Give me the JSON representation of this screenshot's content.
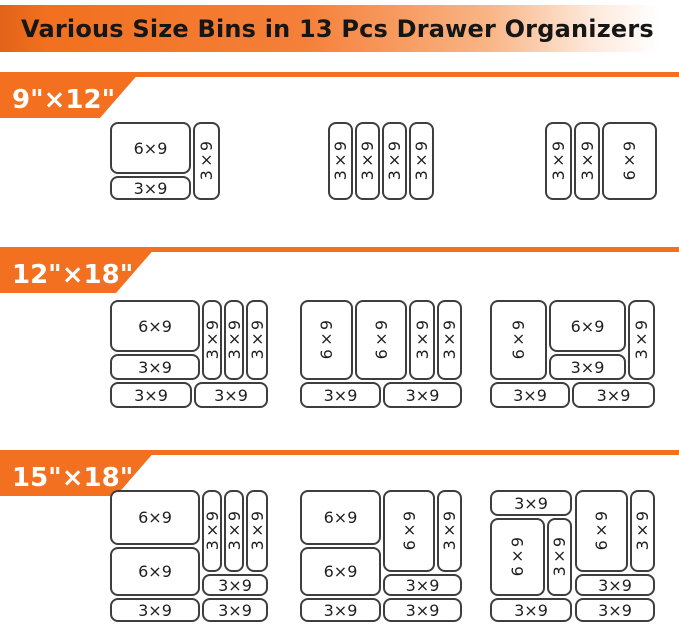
{
  "title": "Various Size Bins in 13 Pcs Drawer Organizers",
  "colors": {
    "accent": "#F2701F",
    "bin_border": "#3E3E3E",
    "title_text": "#161616",
    "section_label_text": "#FFFFFF"
  },
  "sections": [
    {
      "label": "9\"×12\"",
      "divider_y": 72,
      "label_width": 140,
      "arrangements": [
        {
          "x": 110,
          "y": 122,
          "w": 110,
          "h": 78,
          "bins": [
            {
              "label": "6×9",
              "orient": "h",
              "x": 0,
              "y": 0,
              "w": 81,
              "h": 52
            },
            {
              "label": "3×9",
              "orient": "h",
              "x": 0,
              "y": 54,
              "w": 81,
              "h": 24
            },
            {
              "label": "3×9",
              "orient": "v",
              "x": 83,
              "y": 0,
              "w": 27,
              "h": 78
            }
          ]
        },
        {
          "x": 328,
          "y": 122,
          "w": 106,
          "h": 78,
          "bins": [
            {
              "label": "3×9",
              "orient": "v",
              "x": 0,
              "y": 0,
              "w": 25,
              "h": 78
            },
            {
              "label": "3×9",
              "orient": "v",
              "x": 27,
              "y": 0,
              "w": 25,
              "h": 78
            },
            {
              "label": "3×9",
              "orient": "v",
              "x": 54,
              "y": 0,
              "w": 25,
              "h": 78
            },
            {
              "label": "3×9",
              "orient": "v",
              "x": 81,
              "y": 0,
              "w": 25,
              "h": 78
            }
          ]
        },
        {
          "x": 545,
          "y": 122,
          "w": 112,
          "h": 78,
          "bins": [
            {
              "label": "3×9",
              "orient": "v",
              "x": 0,
              "y": 0,
              "w": 27,
              "h": 78
            },
            {
              "label": "3×9",
              "orient": "v",
              "x": 29,
              "y": 0,
              "w": 26,
              "h": 78
            },
            {
              "label": "6×9",
              "orient": "v",
              "x": 57,
              "y": 0,
              "w": 55,
              "h": 78
            }
          ]
        }
      ]
    },
    {
      "label": "12\"×18\"",
      "divider_y": 247,
      "label_width": 156,
      "arrangements": [
        {
          "x": 110,
          "y": 300,
          "w": 158,
          "h": 108,
          "bins": [
            {
              "label": "6×9",
              "orient": "h",
              "x": 0,
              "y": 0,
              "w": 90,
              "h": 52
            },
            {
              "label": "3×9",
              "orient": "h",
              "x": 0,
              "y": 54,
              "w": 90,
              "h": 26
            },
            {
              "label": "3×9",
              "orient": "v",
              "x": 92,
              "y": 0,
              "w": 20,
              "h": 80
            },
            {
              "label": "3×9",
              "orient": "v",
              "x": 114,
              "y": 0,
              "w": 20,
              "h": 80
            },
            {
              "label": "3×9",
              "orient": "v",
              "x": 136,
              "y": 0,
              "w": 22,
              "h": 80
            },
            {
              "label": "3×9",
              "orient": "h",
              "x": 0,
              "y": 82,
              "w": 82,
              "h": 26
            },
            {
              "label": "3×9",
              "orient": "h",
              "x": 84,
              "y": 82,
              "w": 74,
              "h": 26
            }
          ]
        },
        {
          "x": 300,
          "y": 300,
          "w": 162,
          "h": 108,
          "bins": [
            {
              "label": "6×9",
              "orient": "v",
              "x": 0,
              "y": 0,
              "w": 53,
              "h": 80
            },
            {
              "label": "6×9",
              "orient": "v",
              "x": 55,
              "y": 0,
              "w": 52,
              "h": 80
            },
            {
              "label": "3×9",
              "orient": "v",
              "x": 109,
              "y": 0,
              "w": 26,
              "h": 80
            },
            {
              "label": "3×9",
              "orient": "v",
              "x": 137,
              "y": 0,
              "w": 25,
              "h": 80
            },
            {
              "label": "3×9",
              "orient": "h",
              "x": 0,
              "y": 82,
              "w": 81,
              "h": 26
            },
            {
              "label": "3×9",
              "orient": "h",
              "x": 83,
              "y": 82,
              "w": 79,
              "h": 26
            }
          ]
        },
        {
          "x": 490,
          "y": 300,
          "w": 165,
          "h": 108,
          "bins": [
            {
              "label": "6×9",
              "orient": "v",
              "x": 0,
              "y": 0,
              "w": 57,
              "h": 80
            },
            {
              "label": "6×9",
              "orient": "h",
              "x": 59,
              "y": 0,
              "w": 77,
              "h": 52
            },
            {
              "label": "3×9",
              "orient": "h",
              "x": 59,
              "y": 54,
              "w": 77,
              "h": 26
            },
            {
              "label": "3×9",
              "orient": "v",
              "x": 138,
              "y": 0,
              "w": 27,
              "h": 80
            },
            {
              "label": "3×9",
              "orient": "h",
              "x": 0,
              "y": 82,
              "w": 80,
              "h": 26
            },
            {
              "label": "3×9",
              "orient": "h",
              "x": 82,
              "y": 82,
              "w": 83,
              "h": 26
            }
          ]
        }
      ]
    },
    {
      "label": "15\"×18\"",
      "divider_y": 450,
      "label_width": 156,
      "arrangements": [
        {
          "x": 110,
          "y": 490,
          "w": 158,
          "h": 132,
          "bins": [
            {
              "label": "6×9",
              "orient": "h",
              "x": 0,
              "y": 0,
              "w": 90,
              "h": 55
            },
            {
              "label": "6×9",
              "orient": "h",
              "x": 0,
              "y": 57,
              "w": 90,
              "h": 49
            },
            {
              "label": "3×9",
              "orient": "v",
              "x": 92,
              "y": 0,
              "w": 20,
              "h": 82
            },
            {
              "label": "3×9",
              "orient": "v",
              "x": 114,
              "y": 0,
              "w": 20,
              "h": 82
            },
            {
              "label": "3×9",
              "orient": "v",
              "x": 136,
              "y": 0,
              "w": 22,
              "h": 82
            },
            {
              "label": "3×9",
              "orient": "h",
              "x": 92,
              "y": 84,
              "w": 66,
              "h": 22
            },
            {
              "label": "3×9",
              "orient": "h",
              "x": 0,
              "y": 108,
              "w": 90,
              "h": 24
            },
            {
              "label": "3×9",
              "orient": "h",
              "x": 92,
              "y": 108,
              "w": 66,
              "h": 24
            }
          ]
        },
        {
          "x": 300,
          "y": 490,
          "w": 162,
          "h": 132,
          "bins": [
            {
              "label": "6×9",
              "orient": "h",
              "x": 0,
              "y": 0,
              "w": 81,
              "h": 55
            },
            {
              "label": "6×9",
              "orient": "h",
              "x": 0,
              "y": 57,
              "w": 81,
              "h": 49
            },
            {
              "label": "6×9",
              "orient": "v",
              "x": 83,
              "y": 0,
              "w": 52,
              "h": 82
            },
            {
              "label": "3×9",
              "orient": "v",
              "x": 137,
              "y": 0,
              "w": 25,
              "h": 82
            },
            {
              "label": "3×9",
              "orient": "h",
              "x": 83,
              "y": 84,
              "w": 79,
              "h": 22
            },
            {
              "label": "3×9",
              "orient": "h",
              "x": 0,
              "y": 108,
              "w": 81,
              "h": 24
            },
            {
              "label": "3×9",
              "orient": "h",
              "x": 83,
              "y": 108,
              "w": 79,
              "h": 24
            }
          ]
        },
        {
          "x": 490,
          "y": 490,
          "w": 165,
          "h": 132,
          "bins": [
            {
              "label": "3×9",
              "orient": "h",
              "x": 0,
              "y": 0,
              "w": 82,
              "h": 26
            },
            {
              "label": "6×9",
              "orient": "v",
              "x": 0,
              "y": 28,
              "w": 55,
              "h": 78
            },
            {
              "label": "3×9",
              "orient": "v",
              "x": 57,
              "y": 28,
              "w": 25,
              "h": 78
            },
            {
              "label": "6×9",
              "orient": "v",
              "x": 85,
              "y": 0,
              "w": 53,
              "h": 82
            },
            {
              "label": "3×9",
              "orient": "v",
              "x": 140,
              "y": 0,
              "w": 25,
              "h": 82
            },
            {
              "label": "3×9",
              "orient": "h",
              "x": 85,
              "y": 84,
              "w": 80,
              "h": 22
            },
            {
              "label": "3×9",
              "orient": "h",
              "x": 0,
              "y": 108,
              "w": 82,
              "h": 24
            },
            {
              "label": "3×9",
              "orient": "h",
              "x": 85,
              "y": 108,
              "w": 80,
              "h": 24
            }
          ]
        }
      ]
    }
  ]
}
